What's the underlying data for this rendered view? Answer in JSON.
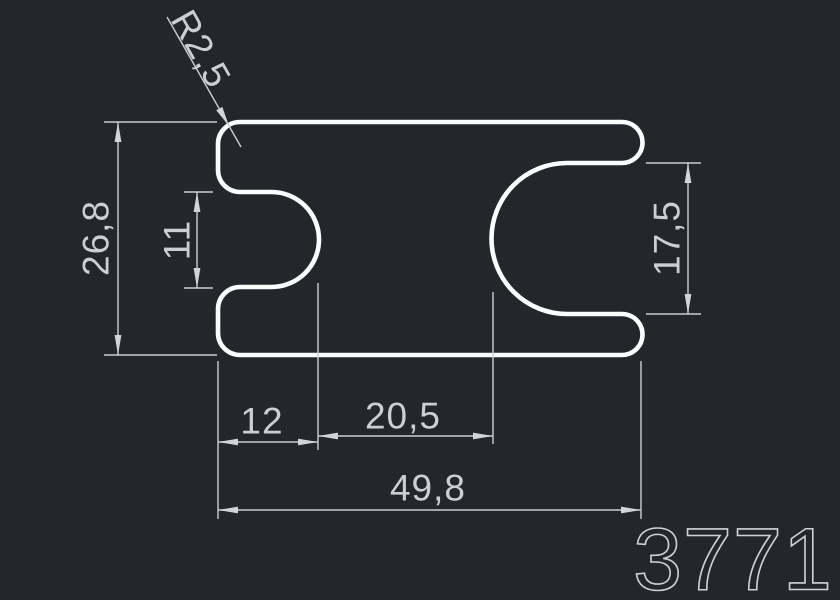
{
  "drawing": {
    "part_number": "3771",
    "dimensions": {
      "corner_radius": "R2,5",
      "overall_height": "26,8",
      "left_slot_opening": "11",
      "right_slot_opening": "17,5",
      "left_slot_depth": "12",
      "center_distance": "20,5",
      "overall_width": "49,8"
    },
    "colors": {
      "background": "#23262a",
      "outline": "#fbfcfd",
      "dimension": "#ccced1"
    }
  }
}
